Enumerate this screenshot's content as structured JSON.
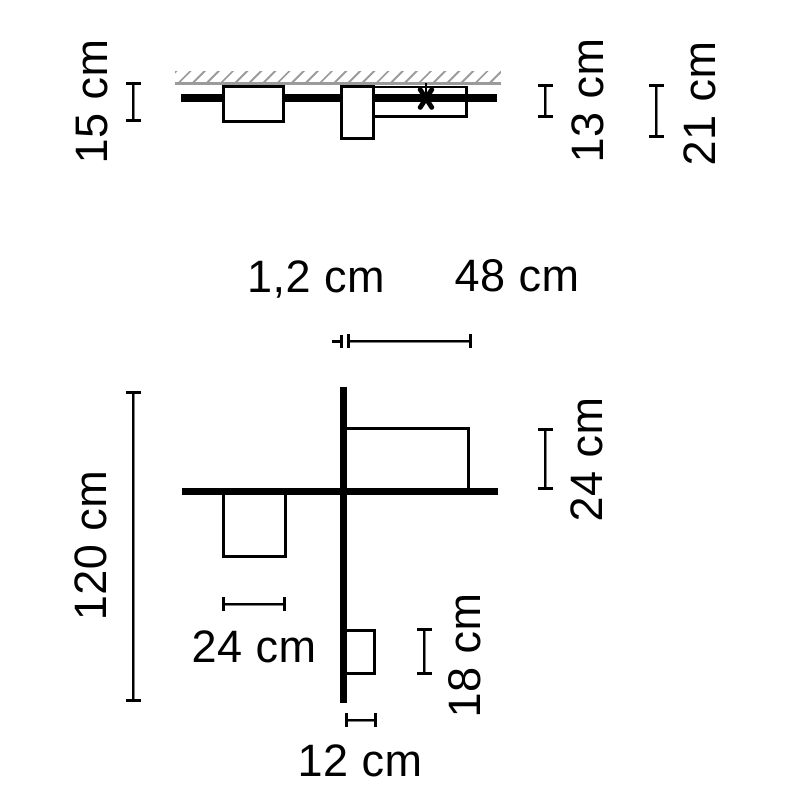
{
  "colors": {
    "line": "#000000",
    "hatch": "#9b9b9b",
    "background": "#ffffff"
  },
  "elevation_view": {
    "dims": {
      "box_drop": "15 cm",
      "panel_drop": "13 cm",
      "lower_box_drop": "21 cm"
    },
    "icons": {
      "connection_marker": "asterisk"
    }
  },
  "plan_view": {
    "dims": {
      "blade_thickness": "1,2 cm",
      "top_panel_width": "48 cm",
      "total_length": "120 cm",
      "top_panel_depth": "24 cm",
      "left_box_width": "24 cm",
      "small_box_depth": "18 cm",
      "small_box_width": "12 cm"
    }
  }
}
